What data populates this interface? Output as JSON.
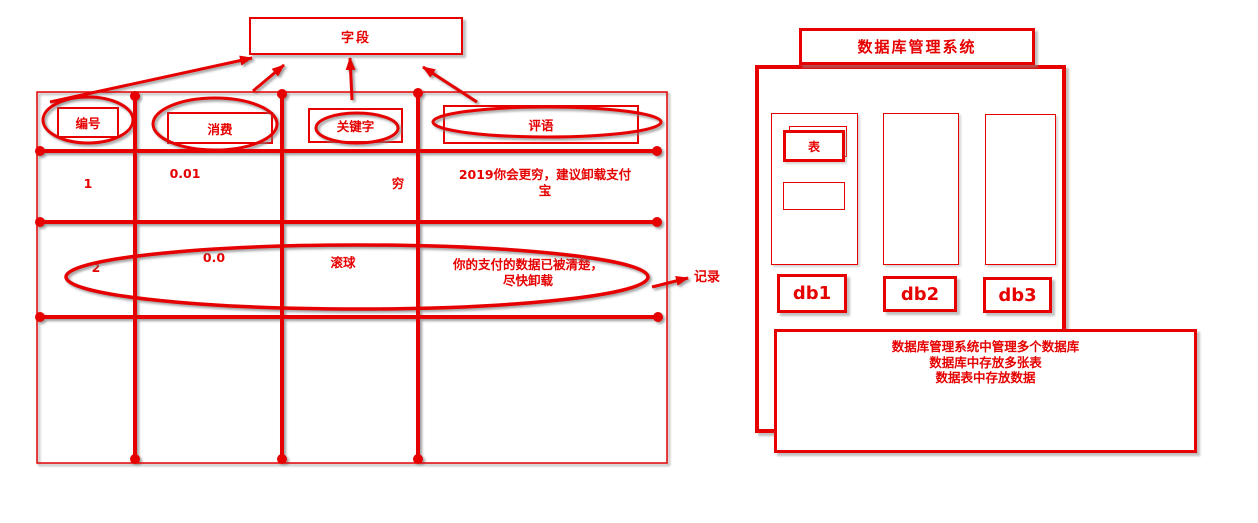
{
  "colors": {
    "accent_red": "#e60000"
  },
  "field_callout": {
    "label": "字段"
  },
  "table": {
    "headers": [
      {
        "label": "编号"
      },
      {
        "label": "消费"
      },
      {
        "label": "关键字"
      },
      {
        "label": "评语"
      }
    ],
    "rows": [
      {
        "id": "1",
        "cost": "0.01",
        "keyword": "穷",
        "comment": "2019你会更穷，建议卸载支付宝"
      },
      {
        "id": "2",
        "cost": "0.0",
        "keyword": "滚球",
        "comment": "你的支付的数据已被清楚，尽快卸载"
      }
    ],
    "record_label": "记录"
  },
  "dbms": {
    "title": "数据库管理系统",
    "table_box_label": "表",
    "db_labels": [
      "db1",
      "db2",
      "db3"
    ],
    "note_lines": [
      "数据库管理系统中管理多个数据库",
      "数据库中存放多张表",
      "数据表中存放数据"
    ]
  }
}
